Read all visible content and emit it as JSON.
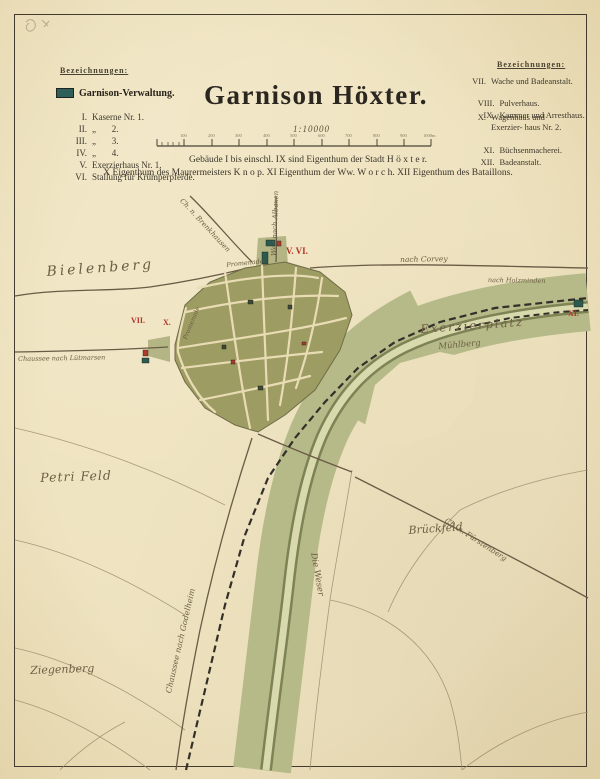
{
  "page": {
    "paper_color": "#eee2bf",
    "frame_color": "#433b2e"
  },
  "title": "Garnison Höxter.",
  "scale": {
    "ratio": "1:10000",
    "tick_labels": [
      "100",
      "200",
      "300",
      "400",
      "500",
      "600",
      "700",
      "800",
      "900",
      "1000m"
    ]
  },
  "notes": {
    "line1": "Gebäude I bis einschl. IX sind Eigenthum der Stadt H ö x t e r.",
    "line2": "X Eigenthum des Maurermeisters K n o p.   XI Eigenthum der Ww. W o r c h.   XII Eigenthum des Bataillons."
  },
  "legend_left": {
    "header": "Bezeichnungen:",
    "swatch_color": "#2e5f58",
    "swatch_label": "Garnison-Verwaltung.",
    "items": [
      {
        "num": "I.",
        "text": "Kaserne Nr. 1."
      },
      {
        "num": "II.",
        "text": "„       2."
      },
      {
        "num": "III.",
        "text": "„       3."
      },
      {
        "num": "IV.",
        "text": "„       4."
      },
      {
        "num": "V.",
        "text": "Exerzierhaus Nr. 1."
      },
      {
        "num": "VI.",
        "text": "Stallung für Krümperpferde."
      }
    ]
  },
  "legend_right": {
    "header": "Bezeichnungen:",
    "items": [
      {
        "num": "VII.",
        "text": "Wache und Badeanstalt."
      },
      {
        "num": "VIII.",
        "text": "Pulverhaus."
      },
      {
        "num": "IX.",
        "text": "Kammer und Arresthaus."
      },
      {
        "num": "X.",
        "text": "Wagenhaus und Exerzier- haus Nr. 2."
      },
      {
        "num": "XI.",
        "text": "Büchsenmacherei."
      },
      {
        "num": "XII.",
        "text": "Badeanstalt."
      }
    ]
  },
  "map": {
    "colors": {
      "town_fill": "#9d9c62",
      "meadow": "#b6ba88",
      "river_bank": "#7d8355",
      "river_water": "#d8d9ad",
      "road": "#6a5b45",
      "railway": "#33302a",
      "building_green": "#2c5a4e",
      "building_red": "#b03a2c",
      "red_numeral": "#b23225"
    },
    "labels": [
      {
        "text": "Bielenberg"
      },
      {
        "text": "Exerzierplatz"
      },
      {
        "text": "Mühlberg"
      },
      {
        "text": "Petri Feld"
      },
      {
        "text": "Brückfeld"
      },
      {
        "text": "Ziegenberg"
      },
      {
        "text": "Die Weser"
      },
      {
        "text": "Chaussee nach Godelheim"
      },
      {
        "text": "Chaussee nach Lütmarsen"
      },
      {
        "text": "Ch. n. Brenkhausen"
      },
      {
        "text": "Weg nach Albaxen"
      },
      {
        "text": "nach Corvey"
      },
      {
        "text": "nach Holzminden"
      },
      {
        "text": "Ch. n. Fürstenberg"
      },
      {
        "text": "Promenade"
      },
      {
        "text": "Promenade"
      }
    ],
    "red_marks": [
      {
        "text": "V. VI."
      },
      {
        "text": "VII."
      },
      {
        "text": "X."
      },
      {
        "text": "XI."
      }
    ]
  }
}
